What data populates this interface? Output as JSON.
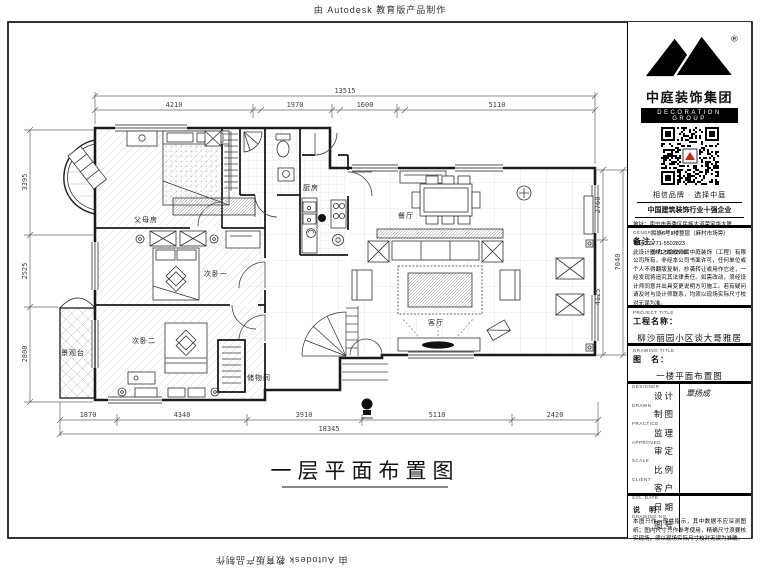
{
  "watermark": {
    "top": "由 Autodesk 教育版产品制作",
    "bottom": "由 Autodesk 教育版产品制作"
  },
  "brand": {
    "name": "中庭装饰集团",
    "subtitle": "DECORATION GROUP",
    "registered": "®",
    "tagline": "相信品牌 · 选择中庭",
    "honor": "中国建筑装饰行业十强企业",
    "address_line1": "地址：南宁市青秀区民族大道荣宝华大厦",
    "address_line2": "民族6号3楼整层（麻村市场旁）",
    "phone_line1": "电话：0771-5502823",
    "phone_line2": "0771-5510566"
  },
  "general_note": {
    "en": "GENERAL NOTE",
    "label": "备注：",
    "text": "此设计图纸之版权归属中庭装饰（工程）有限公司所有，非经本公司书面许可，任何单位或个人不得翻版复制、抄袭转让或用作它途，一经发现将追究其法律责任。如需改动，须经设计师同意并出具变更说明方可施工。若有疑问请及时与设计师联系，均须以现场实际尺寸校对无误为准。"
  },
  "project": {
    "en": "PROJECT TITLE",
    "label": "工程名称：",
    "value": "柳沙丽园小区谈大哥雅居"
  },
  "drawing": {
    "en": "DRAWING TITLE",
    "label": "图　名：",
    "value": "一楼平面布置图"
  },
  "fields": [
    {
      "en": "DESIGNER",
      "label": "设计",
      "value": "覃扬成"
    },
    {
      "en": "DRAWN",
      "label": "制图",
      "value": ""
    },
    {
      "en": "PRACTICE",
      "label": "监理",
      "value": ""
    },
    {
      "en": "APPROVED",
      "label": "审定",
      "value": ""
    },
    {
      "en": "SCALE",
      "label": "比例",
      "value": ""
    },
    {
      "en": "CLIENT",
      "label": "客户",
      "value": ""
    },
    {
      "en": "SIG. DATE",
      "label": "日期",
      "value": ""
    },
    {
      "en": "DRAWING NO",
      "label": "图号",
      "value": ""
    }
  ],
  "final_note": {
    "label": "说　明：",
    "text": "本图只作一般性指示，其中数据不应深测图纸；图内尺寸只作参考使用，精确尺寸须要核实现场，须以现场实际尺寸校对无误为准确。"
  },
  "plan": {
    "title": "一层平面布置图",
    "rooms": {
      "parents": "父母房",
      "bed1": "次卧一",
      "bed2": "次卧二",
      "kitchen": "厨房",
      "dining": "餐厅",
      "living": "客厅",
      "deck": "景观台",
      "storage": "储物间"
    },
    "dimensions": {
      "top_total": "13515",
      "top": [
        "4210",
        "1970",
        "1600",
        "5110"
      ],
      "bottom": [
        "1870",
        "4340",
        "3910",
        "5110",
        "2420"
      ],
      "bottom_total": "18345",
      "left": [
        "3395",
        "2525",
        "2800"
      ],
      "right": [
        "2760",
        "4125"
      ],
      "right_total": "7040"
    }
  },
  "colors": {
    "line": "#1a1a1a",
    "hatch": "#c9c9c9",
    "accent_red": "#c0261d"
  }
}
